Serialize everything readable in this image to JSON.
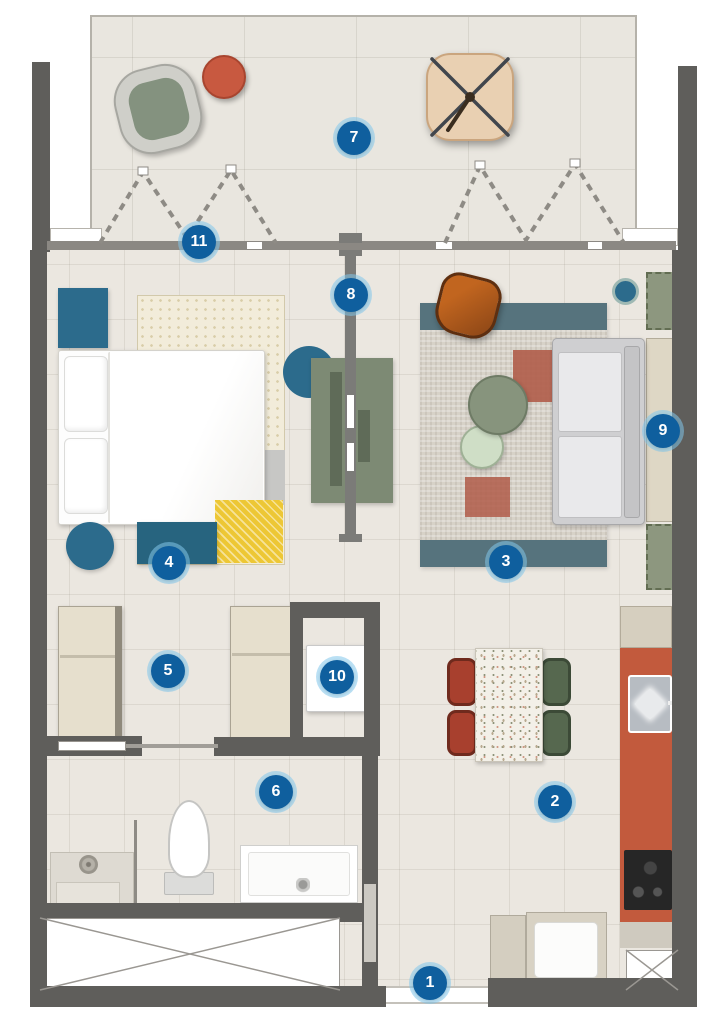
{
  "title": "Apartment unit floor plan",
  "badges": [
    {
      "label": "1"
    },
    {
      "label": "2"
    },
    {
      "label": "3"
    },
    {
      "label": "4"
    },
    {
      "label": "5"
    },
    {
      "label": "6"
    },
    {
      "label": "7"
    },
    {
      "label": "8"
    },
    {
      "label": "9"
    },
    {
      "label": "10"
    },
    {
      "label": "11"
    }
  ],
  "colors": {
    "wall": "#5f5e5b",
    "glass": "#8b8883",
    "floor": "#ebe7e0",
    "balcony": "#e9e6df",
    "badge": "#0f5f9e",
    "badgering": "rgba(130,198,235,0.55)",
    "teal": "#2c6b8c",
    "tealdark": "#27647f",
    "rugcream": "#f2ecda",
    "rugdot": "#d8cda8",
    "rugyellow": "#edc735",
    "rugband": "#56737d",
    "rugliving": "#d7d2c8",
    "rust": "#b05c49",
    "sage": "#87947d",
    "sagelight": "#cfdec6",
    "sagedark": "#5f6b58",
    "dividergreen": "#7d8a74",
    "armchair": "#b05a23",
    "sofaframe": "#cfcfd1",
    "sofacushion": "#e9e9eb",
    "unitbeige": "#ded7c5",
    "greensquare": "#8d977f",
    "wardrobe": "#e6dfcd",
    "kitchenred": "#c25a3d",
    "cooktop": "#262626",
    "chairred": "#a8402e",
    "chairgreen": "#56684f",
    "lounge": "#84927f",
    "pouf": "#c85940",
    "umbrella": "#e9d0b2"
  }
}
